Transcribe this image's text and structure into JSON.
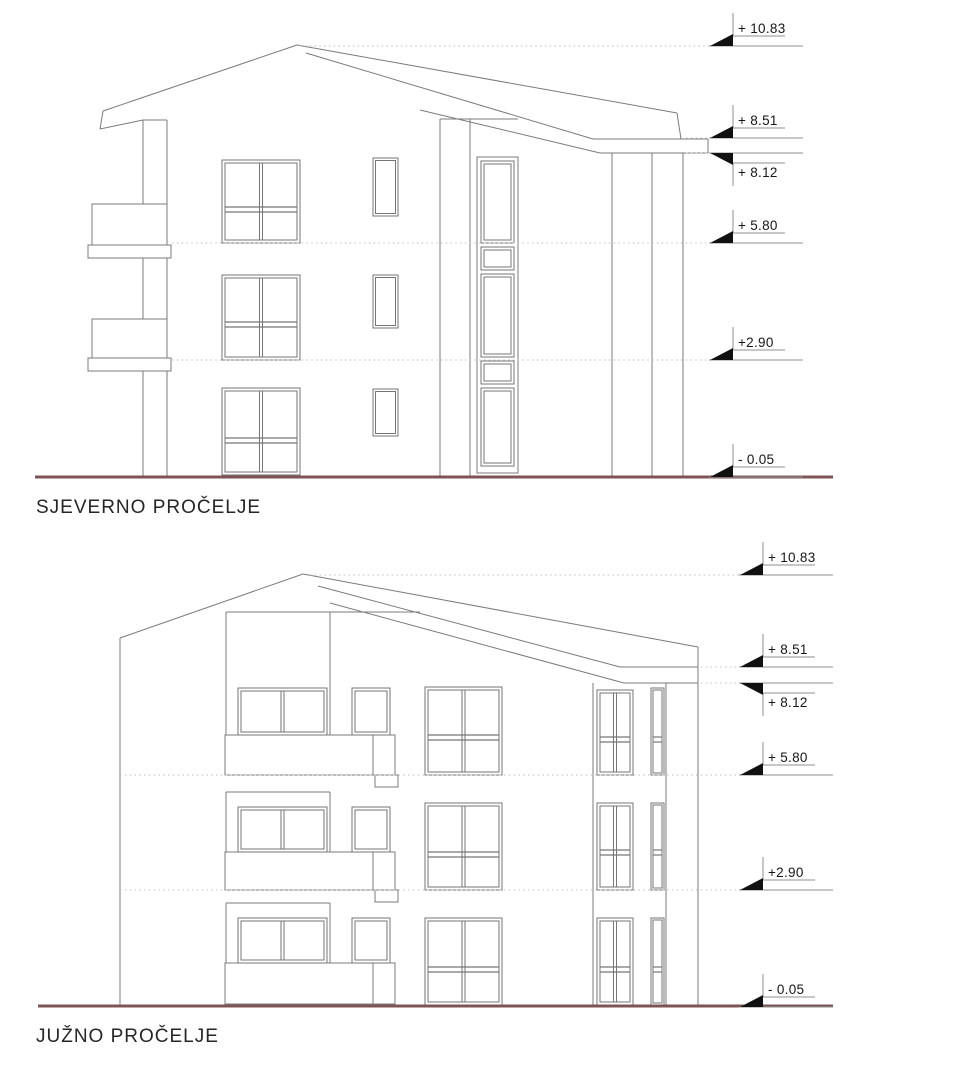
{
  "sheet": {
    "background": "#ffffff",
    "line_color": "#7b7b7b",
    "window_line_color": "#767676",
    "ground_color": "#7c5454",
    "dotted_color": "#c4c2bf",
    "marker_line_color": "#8f8f8f",
    "marker_triangle_color": "#111111",
    "text_color": "#161616"
  },
  "north": {
    "title": "SJEVERNO PROČELJE",
    "markers": [
      {
        "label": "+ 10.83",
        "y": 46,
        "leader_from": 300,
        "inverted": false
      },
      {
        "label": "+ 8.51",
        "y": 138,
        "leader_from": 686,
        "inverted": false
      },
      {
        "label": "+ 8.12",
        "y": 153,
        "leader_from": 686,
        "inverted": true
      },
      {
        "label": "+ 5.80",
        "y": 243,
        "leader_from": 172,
        "inverted": false
      },
      {
        "label": "+2.90",
        "y": 360,
        "leader_from": 172,
        "inverted": false
      },
      {
        "label": "- 0.05",
        "y": 477,
        "leader_from": null,
        "inverted": false
      }
    ]
  },
  "south": {
    "title": "JUŽNO PROČELJE",
    "markers": [
      {
        "label": "+ 10.83",
        "y": 575,
        "leader_from": 310,
        "inverted": false
      },
      {
        "label": "+ 8.51",
        "y": 667,
        "leader_from": 701,
        "inverted": false
      },
      {
        "label": "+ 8.12",
        "y": 683,
        "leader_from": 701,
        "inverted": true
      },
      {
        "label": "+ 5.80",
        "y": 775,
        "leader_from": 120,
        "inverted": false
      },
      {
        "label": "+2.90",
        "y": 890,
        "leader_from": 120,
        "inverted": false
      },
      {
        "label": "- 0.05",
        "y": 1007,
        "leader_from": null,
        "inverted": false
      }
    ]
  }
}
